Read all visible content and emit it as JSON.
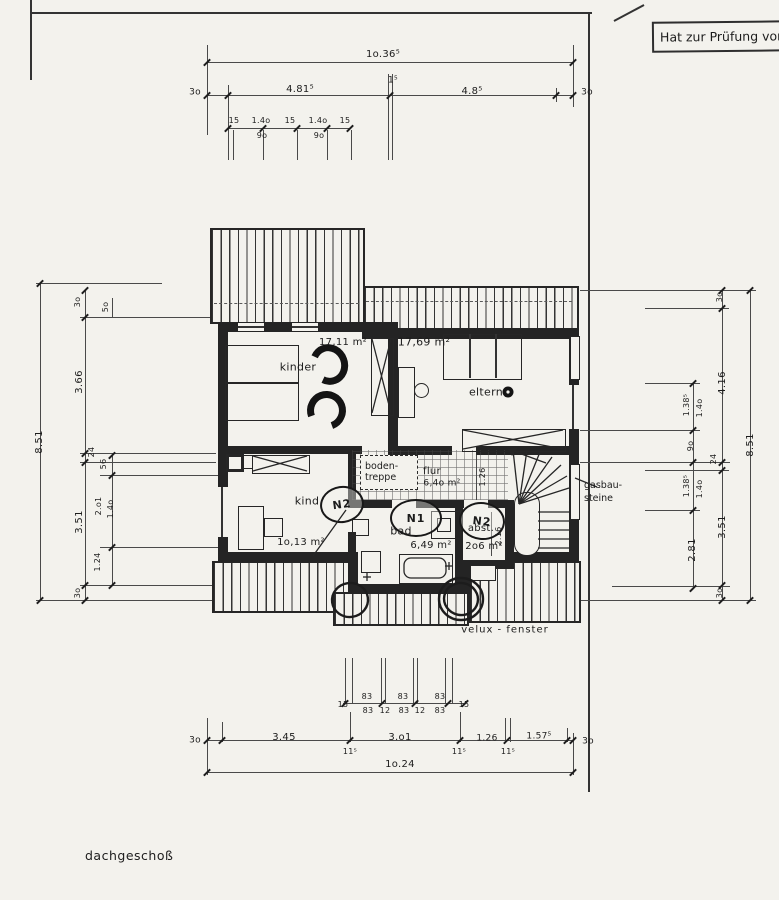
{
  "sheet": {
    "stamp_text": "Hat zur Prüfung vor",
    "floor_label": "dachgeschoß"
  },
  "annotations": {
    "attic_stairs": [
      "boden-",
      "treppe"
    ],
    "material_note": [
      "gasbau-",
      "steine"
    ],
    "window_note": "velux - fenster"
  },
  "door_tags": [
    "N2",
    "N1",
    "N2"
  ],
  "labels": {
    "dims_top": [
      {
        "t": "1o.36⁵",
        "x": 383,
        "y": 55
      },
      {
        "t": "3o",
        "x": 195,
        "y": 93,
        "fs": 9
      },
      {
        "t": "4.81⁵",
        "x": 300,
        "y": 90
      },
      {
        "t": "1⁵",
        "x": 393,
        "y": 81,
        "fs": 9
      },
      {
        "t": "4.8⁵",
        "x": 472,
        "y": 92
      },
      {
        "t": "3o",
        "x": 587,
        "y": 93,
        "fs": 9
      },
      {
        "t": "15",
        "x": 234,
        "y": 121,
        "fs": 8
      },
      {
        "t": "1.4o",
        "x": 261,
        "y": 121,
        "fs": 8
      },
      {
        "t": "15",
        "x": 290,
        "y": 121,
        "fs": 8
      },
      {
        "t": "1.4o",
        "x": 318,
        "y": 121,
        "fs": 8
      },
      {
        "t": "15",
        "x": 345,
        "y": 121,
        "fs": 8
      },
      {
        "t": "9o",
        "x": 262,
        "y": 136,
        "fs": 8
      },
      {
        "t": "9o",
        "x": 319,
        "y": 136,
        "fs": 8
      }
    ],
    "dims_left": [
      {
        "t": "8.51",
        "x": 40,
        "y": 442,
        "rot": 1
      },
      {
        "t": "3o",
        "x": 78,
        "y": 302,
        "rot": 1,
        "fs": 8
      },
      {
        "t": "5o",
        "x": 106,
        "y": 307,
        "rot": 1,
        "fs": 8
      },
      {
        "t": "3.66",
        "x": 80,
        "y": 382,
        "rot": 1
      },
      {
        "t": "24",
        "x": 92,
        "y": 452,
        "rot": 1,
        "fs": 8
      },
      {
        "t": "56",
        "x": 104,
        "y": 464,
        "rot": 1,
        "fs": 8
      },
      {
        "t": "2.o1",
        "x": 99,
        "y": 506,
        "rot": 1,
        "fs": 8
      },
      {
        "t": "1.4o",
        "x": 111,
        "y": 509,
        "rot": 1,
        "fs": 8
      },
      {
        "t": "3.51",
        "x": 80,
        "y": 522,
        "rot": 1
      },
      {
        "t": "1.24",
        "x": 98,
        "y": 562,
        "rot": 1,
        "fs": 8
      },
      {
        "t": "3o",
        "x": 78,
        "y": 593,
        "rot": 1,
        "fs": 8
      }
    ],
    "dims_right": [
      {
        "t": "3o",
        "x": 720,
        "y": 297,
        "rot": 1,
        "fs": 8
      },
      {
        "t": "4.16",
        "x": 723,
        "y": 383,
        "rot": 1
      },
      {
        "t": "1.38⁵",
        "x": 687,
        "y": 405,
        "rot": 1,
        "fs": 8
      },
      {
        "t": "1.4o",
        "x": 700,
        "y": 408,
        "rot": 1,
        "fs": 8
      },
      {
        "t": "9o",
        "x": 691,
        "y": 446,
        "rot": 1,
        "fs": 8
      },
      {
        "t": "24",
        "x": 714,
        "y": 459,
        "rot": 1,
        "fs": 8
      },
      {
        "t": "1.38⁵",
        "x": 687,
        "y": 486,
        "rot": 1,
        "fs": 8
      },
      {
        "t": "1.4o",
        "x": 700,
        "y": 489,
        "rot": 1,
        "fs": 8
      },
      {
        "t": "3.51",
        "x": 723,
        "y": 527,
        "rot": 1
      },
      {
        "t": "2.81",
        "x": 693,
        "y": 550,
        "rot": 1
      },
      {
        "t": "8.51",
        "x": 751,
        "y": 445,
        "rot": 1
      },
      {
        "t": "3o",
        "x": 720,
        "y": 593,
        "rot": 1,
        "fs": 8
      }
    ],
    "dims_bottom": [
      {
        "t": "83",
        "x": 367,
        "y": 697,
        "fs": 8
      },
      {
        "t": "83",
        "x": 403,
        "y": 697,
        "fs": 8
      },
      {
        "t": "83",
        "x": 440,
        "y": 697,
        "fs": 8
      },
      {
        "t": "15",
        "x": 343,
        "y": 705,
        "fs": 8
      },
      {
        "t": "83",
        "x": 368,
        "y": 711,
        "fs": 8
      },
      {
        "t": "12",
        "x": 385,
        "y": 711,
        "fs": 8
      },
      {
        "t": "83",
        "x": 404,
        "y": 711,
        "fs": 8
      },
      {
        "t": "12",
        "x": 420,
        "y": 711,
        "fs": 8
      },
      {
        "t": "83",
        "x": 440,
        "y": 711,
        "fs": 8
      },
      {
        "t": "15",
        "x": 464,
        "y": 705,
        "fs": 8
      },
      {
        "t": "3o",
        "x": 195,
        "y": 741,
        "fs": 9
      },
      {
        "t": "3.45",
        "x": 284,
        "y": 738
      },
      {
        "t": "11⁵",
        "x": 350,
        "y": 752,
        "fs": 8
      },
      {
        "t": "3.o1",
        "x": 400,
        "y": 738
      },
      {
        "t": "11⁵",
        "x": 459,
        "y": 752,
        "fs": 8
      },
      {
        "t": "1.26",
        "x": 487,
        "y": 739,
        "fs": 9
      },
      {
        "t": "11⁵",
        "x": 508,
        "y": 752,
        "fs": 8
      },
      {
        "t": "1.57⁵",
        "x": 539,
        "y": 737,
        "fs": 9
      },
      {
        "t": "3o",
        "x": 588,
        "y": 742,
        "fs": 9
      },
      {
        "t": "1o.24",
        "x": 400,
        "y": 765
      }
    ],
    "rooms": [
      {
        "t": "kinder",
        "x": 298,
        "y": 367,
        "fs": 11
      },
      {
        "t": "17,11 m²",
        "x": 343,
        "y": 343
      },
      {
        "t": "17,69 m²",
        "x": 424,
        "y": 342,
        "fs": 11
      },
      {
        "t": "eltern",
        "x": 486,
        "y": 392,
        "fs": 11
      },
      {
        "t": "kind",
        "x": 307,
        "y": 501,
        "fs": 11
      },
      {
        "t": "1o,13 m²",
        "x": 301,
        "y": 543
      },
      {
        "t": "bad",
        "x": 401,
        "y": 531,
        "fs": 11
      },
      {
        "t": "6,49 m²",
        "x": 431,
        "y": 546
      },
      {
        "t": "abst.",
        "x": 481,
        "y": 529
      },
      {
        "t": "2o6 m²",
        "x": 484,
        "y": 547
      },
      {
        "t": "flur",
        "x": 432,
        "y": 472
      },
      {
        "t": "6,4o m²",
        "x": 442,
        "y": 484,
        "fs": 9
      }
    ],
    "notes": [
      {
        "t": "1.26",
        "x": 483,
        "y": 477,
        "rot": 1,
        "fs": 8
      },
      {
        "t": "2.16",
        "x": 499,
        "y": 536,
        "rot": 1,
        "fs": 8
      }
    ]
  }
}
